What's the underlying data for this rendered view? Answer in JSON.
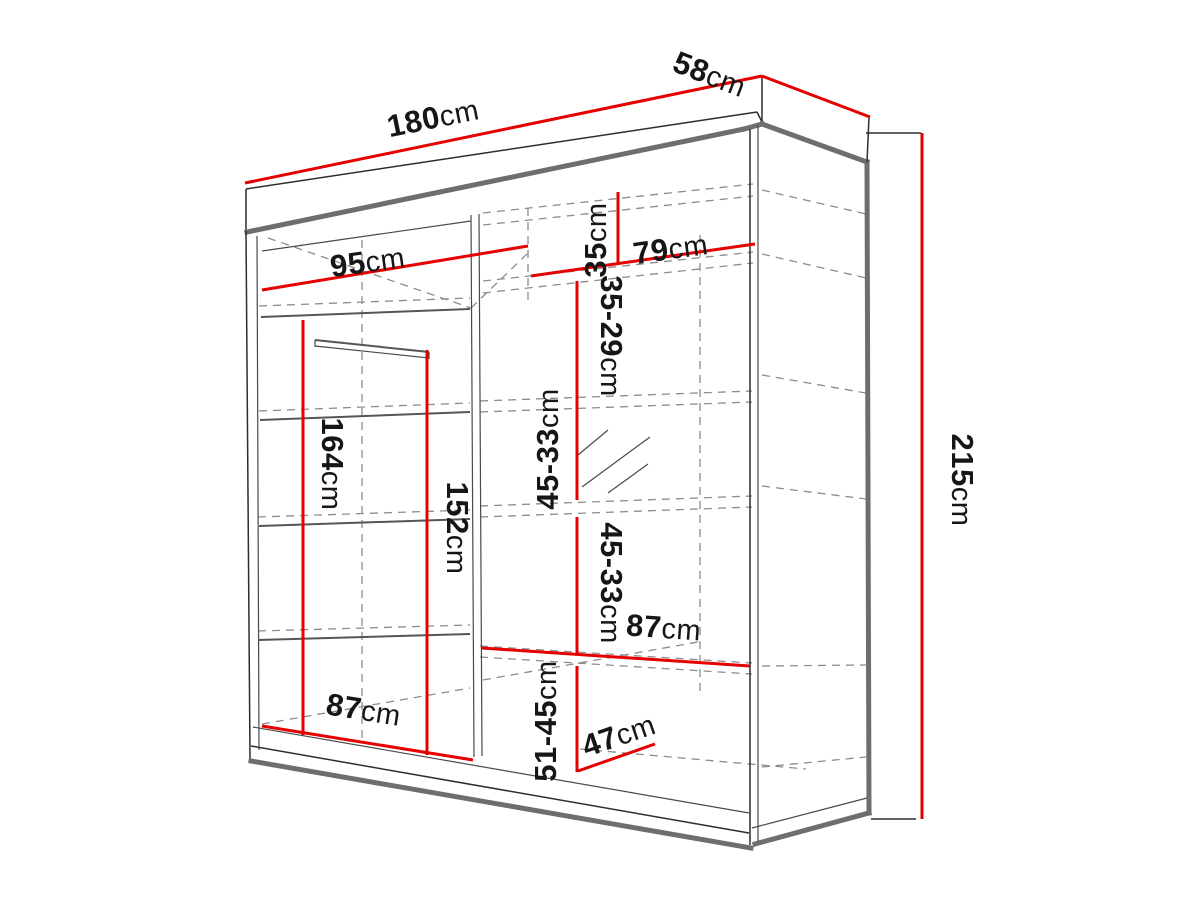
{
  "diagram": {
    "kind": "wardrobe-dimension-drawing",
    "unit": "cm",
    "colors": {
      "dimension_line": "#e60000",
      "outline_thick": "#6e6e6e",
      "outline_thin": "#2d2d2d",
      "dashed_line": "#8c8c8c",
      "label_text": "#161616",
      "background": "#ffffff"
    },
    "dimensions": {
      "width": {
        "value": "180",
        "unit": "cm"
      },
      "depth": {
        "value": "58",
        "unit": "cm"
      },
      "height": {
        "value": "215",
        "unit": "cm"
      },
      "left_inner_width": {
        "value": "95",
        "unit": "cm"
      },
      "right_inner_width": {
        "value": "79",
        "unit": "cm"
      },
      "top_shelf_gap": {
        "value": "35",
        "unit": "cm"
      },
      "shelf_gap_2": {
        "value": "35-29",
        "unit": "cm"
      },
      "shelf_gap_3": {
        "value": "45-33",
        "unit": "cm"
      },
      "shelf_gap_4": {
        "value": "45-33",
        "unit": "cm"
      },
      "left_hang_height": {
        "value": "164",
        "unit": "cm"
      },
      "right_hang_height": {
        "value": "152",
        "unit": "cm"
      },
      "right_shelf_width": {
        "value": "87",
        "unit": "cm"
      },
      "bottom_gap": {
        "value": "51-45",
        "unit": "cm"
      },
      "bottom_shelf_depth": {
        "value": "47",
        "unit": "cm"
      },
      "left_bottom_width": {
        "value": "87",
        "unit": "cm"
      }
    }
  }
}
